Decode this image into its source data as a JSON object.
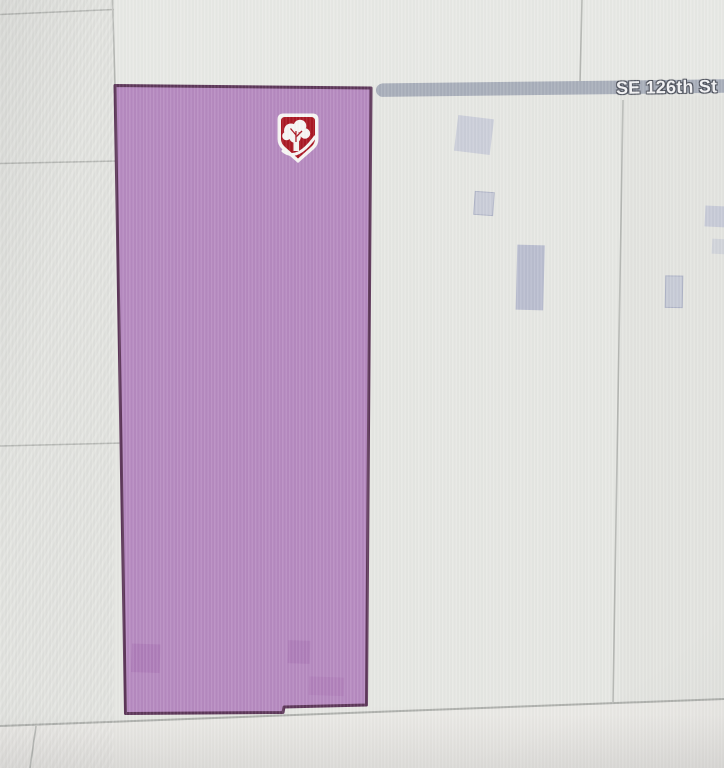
{
  "map": {
    "street_label": "SE 126th St",
    "marker": {
      "icon": "tree-shield-marker-icon",
      "shape": "shield"
    },
    "colors": {
      "map_bg": "#e5e6e2",
      "map_bg_left": "#e2e3df",
      "map_bg_top": "#e8e9e5",
      "map_bg_mid": "#e6e7e3",
      "map_bg_right": "#e3e4e0",
      "map_bg_bottom": "#eae9e5",
      "road_line": "#b5b7b3",
      "road_line_dark": "#aeb0ac",
      "road_band": "#a8aeba",
      "street_label_text": "#f2f2f4",
      "street_label_outline": "#4e525c",
      "parcel_fill": "#b588bf",
      "parcel_border": "#5b3457",
      "building_right": "#c2c6d5",
      "building_right_dark": "#b9bdcf",
      "building_border": "#aeb3c6",
      "building_in_parcel": "#ab79b6",
      "marker_red": "#a91420",
      "marker_white": "#f7f5f4"
    }
  }
}
